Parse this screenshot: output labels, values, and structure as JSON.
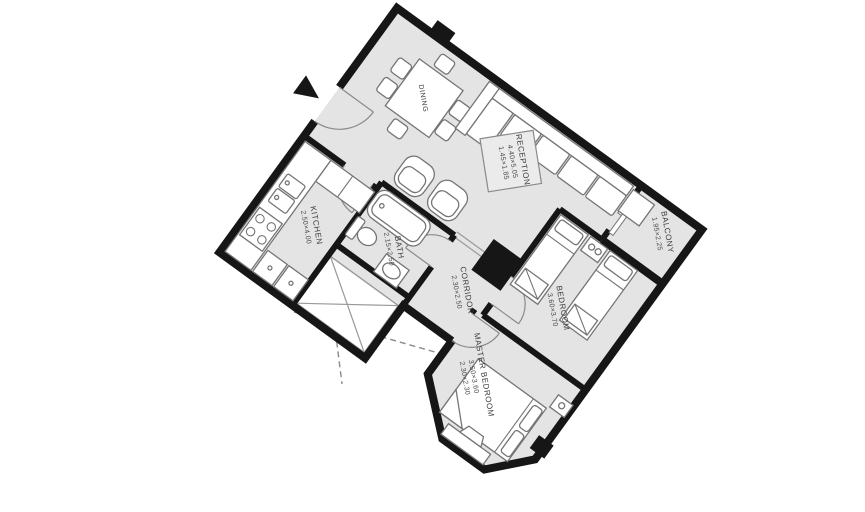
{
  "title": "Apartment floor plan",
  "colors": {
    "background": "#ffffff",
    "floor": "#e4e4e4",
    "wall": "#161616",
    "furniture_outline": "#757575",
    "label_text": "#3c3c3c",
    "dashed_line": "#8a8a8a"
  },
  "rooms": [
    {
      "name": "DINING",
      "dims": []
    },
    {
      "name": "RECEPTION",
      "dims": [
        "4.40×5.05",
        "1.45×1.85"
      ]
    },
    {
      "name": "KITCHEN",
      "dims": [
        "2.50×4.00"
      ]
    },
    {
      "name": "BATH",
      "dims": [
        "2.15×2.50"
      ]
    },
    {
      "name": "CORRIDOR",
      "dims": [
        "2.30×2.50"
      ]
    },
    {
      "name": "BEDROOM",
      "dims": [
        "3.60×3.70"
      ]
    },
    {
      "name": "MASTER BEDROOM",
      "dims": [
        "3.50×3.60",
        "2.30×2.30"
      ]
    },
    {
      "name": "BALCONY",
      "dims": [
        "1.95×2.25"
      ]
    }
  ],
  "icons": {
    "entrance_arrow": "entrance direction arrow"
  }
}
